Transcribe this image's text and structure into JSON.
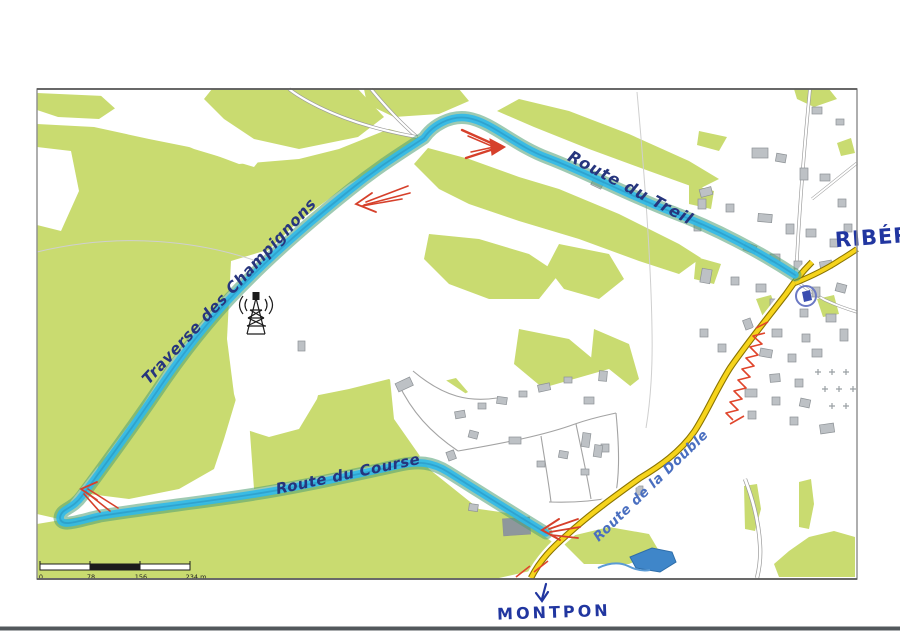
{
  "map": {
    "title": "Hand-annotated route map between Montpon and Ribérac",
    "route_labels": {
      "treil": "Route du Treil",
      "champignons": "Traverse des Champignons",
      "course": "Route du Course",
      "double": "Route de la Double"
    },
    "destinations": {
      "riberac": "RIBÉRAC",
      "montpon": "MONTPON"
    },
    "scale_bar": {
      "ticks": [
        "0",
        "78",
        "156",
        "234 m"
      ]
    },
    "icons": {
      "radio_tower": "radio-tower-icon",
      "church": "church-circle-icon",
      "montpon_arrow": "down-arrow-icon",
      "direction_arrows": "red-direction-arrow-icon"
    },
    "colors": {
      "vegetation": "#c9db70",
      "route_highlight": "#2fb9e9",
      "route_halo": "#4f9f72",
      "main_road": "#f6d41c",
      "ink_blue": "#26357d",
      "ink_light_blue": "#4a6fc0",
      "marker_red": "#d6402b",
      "water": "#3f86c9",
      "building": "#bdc1c5"
    }
  }
}
